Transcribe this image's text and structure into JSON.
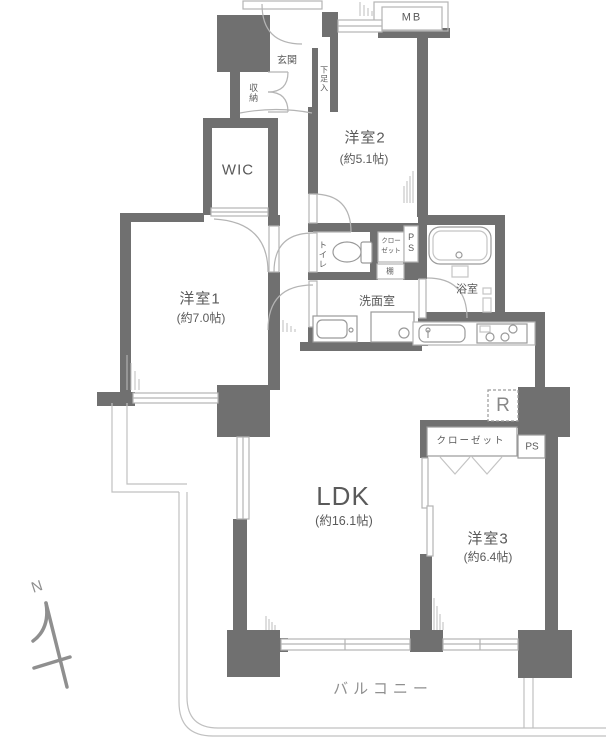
{
  "colors": {
    "wall": "#707070",
    "line": "#b4b4b4",
    "fixture": "#9a9a9a",
    "text": "#5a5a5a",
    "muted": "#8f8f8f"
  },
  "rooms": {
    "genkan": {
      "label": "玄関"
    },
    "shuno": {
      "label": "収納"
    },
    "getabako": {
      "label": "下足入"
    },
    "mb": {
      "label": "MB"
    },
    "yoshitsu2": {
      "label": "洋室2",
      "size": "(約5.1帖)"
    },
    "wic": {
      "label": "WIC"
    },
    "yoshitsu1": {
      "label": "洋室1",
      "size": "(約7.0帖)"
    },
    "toilet": {
      "label": "トイレ"
    },
    "closet_upper": {
      "line1": "クロー",
      "line2": "ゼット"
    },
    "ps_upper": {
      "label": "PS"
    },
    "tana": {
      "label": "棚"
    },
    "bathroom": {
      "label": "浴室"
    },
    "senmenshitsu": {
      "label": "洗面室"
    },
    "ldk": {
      "label": "LDK",
      "size": "(約16.1帖)"
    },
    "yoshitsu3": {
      "label": "洋室3",
      "size": "(約6.4帖)"
    },
    "refrigerator": {
      "label": "R"
    },
    "closet_lower": {
      "label": "クローゼット"
    },
    "ps_lower": {
      "label": "PS"
    },
    "balcony": {
      "label": "バルコニー"
    },
    "compass": {
      "label": "N"
    }
  },
  "icons": [
    "north-arrow-icon",
    "bathtub-icon",
    "toilet-icon",
    "washbasin-icon",
    "washing-machine-icon",
    "kitchen-sink-icon",
    "stove-icon",
    "folding-door-icon"
  ]
}
